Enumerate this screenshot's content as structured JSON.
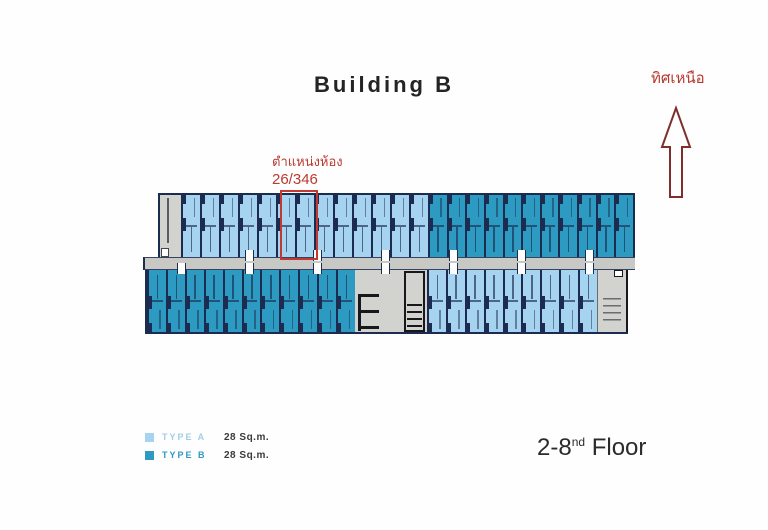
{
  "title": "Building B",
  "north": {
    "label": "ทิศเหนือ"
  },
  "annotation": {
    "line1": "ตำแหน่งห้อง",
    "line2": "26/346"
  },
  "legend": {
    "items": [
      {
        "type": "A",
        "label": "TYPE A",
        "area": "28 Sq.m."
      },
      {
        "type": "B",
        "label": "TYPE B",
        "area": "28 Sq.m."
      }
    ]
  },
  "floor": {
    "range": "2-8",
    "suffix": "nd",
    "word": "Floor"
  },
  "colors": {
    "type_a": "#a6d3ef",
    "type_b": "#2d9ac1",
    "wall": "#1c2b50",
    "corridor": "#c8c8c5",
    "service": "#d2d2cf",
    "annotation_red": "#bb3a30",
    "arrow_outline": "#7e2f2b",
    "legend_a_text": "#9fcfe8",
    "legend_b_text": "#2d9ac1"
  },
  "plan": {
    "bands": [
      {
        "name": "north-wing",
        "side": "top",
        "x": 15,
        "segments": [
          {
            "kind": "stair-strip",
            "width": 23
          },
          {
            "kind": "units",
            "type": "A",
            "count": 13,
            "width": 247
          },
          {
            "kind": "units",
            "type": "B",
            "count": 11,
            "width": 207
          }
        ]
      },
      {
        "name": "south-wing",
        "side": "bottom",
        "x": 2,
        "segments": [
          {
            "kind": "units",
            "type": "B",
            "count": 11,
            "width": 210
          },
          {
            "kind": "service-core",
            "width": 72
          },
          {
            "kind": "units",
            "type": "A",
            "count": 9,
            "width": 170
          },
          {
            "kind": "stair-block",
            "width": 31
          }
        ]
      }
    ],
    "doors": {
      "top": [
        102,
        170,
        238,
        306,
        374,
        442
      ],
      "bottom": [
        34,
        102,
        170,
        238,
        306,
        374,
        442
      ]
    }
  }
}
